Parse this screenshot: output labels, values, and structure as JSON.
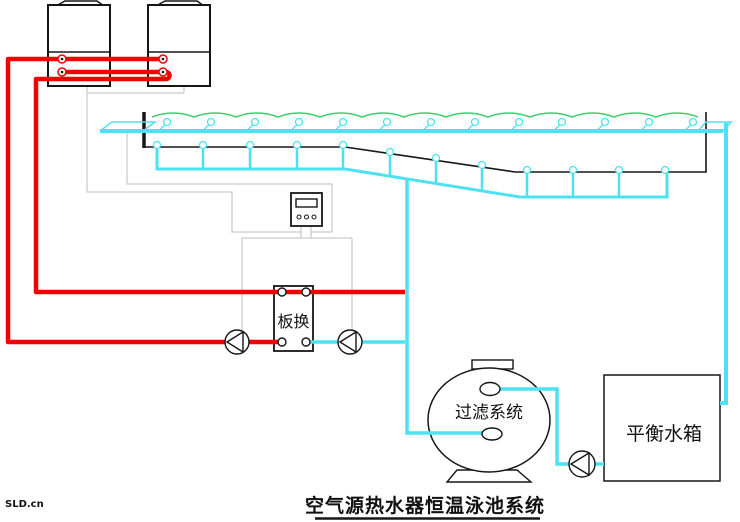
{
  "diagram": {
    "title": "空气源热水器恒温泳池系统",
    "watermark": "SLD.cn",
    "labels": {
      "heat_exchanger": "板换",
      "filter": "过滤系统",
      "balance_tank": "平衡水箱"
    },
    "colors": {
      "hot_pipe": "#f40000",
      "cool_pipe": "#4ee1f2",
      "water_surface": "#3ecf70",
      "wire": "#c9c9c9",
      "outline": "#161616"
    }
  }
}
